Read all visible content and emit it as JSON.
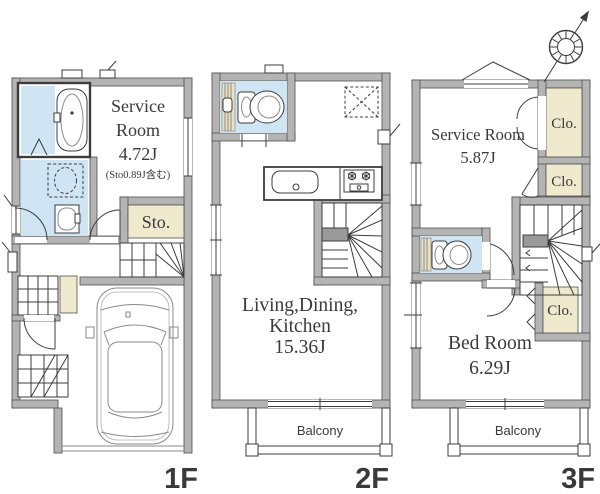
{
  "floor_plan": {
    "floors": [
      {
        "id": "1F",
        "label": "1F",
        "rooms": {
          "service_room": {
            "line1": "Service",
            "line2": "Room",
            "size": "4.72J",
            "note": "(Sto0.89J含む)"
          },
          "storage": "Sto."
        }
      },
      {
        "id": "2F",
        "label": "2F",
        "rooms": {
          "ldk": {
            "line1": "Living,Dining,",
            "line2": "Kitchen",
            "size": "15.36J"
          },
          "balcony": "Balcony"
        }
      },
      {
        "id": "3F",
        "label": "3F",
        "rooms": {
          "service_room": {
            "name": "Service Room",
            "size": "5.87J"
          },
          "closet_top": "Clo.",
          "closet_mid": "Clo.",
          "closet_lower": "Clo.",
          "bedroom": {
            "name": "Bed Room",
            "size": "6.29J"
          },
          "balcony": "Balcony"
        }
      }
    ],
    "colors": {
      "wall_gray": "#b4b4b4",
      "water_blue": "#cfe5f4",
      "closet_cream": "#efe9cd",
      "floor_label_green": "#19573b",
      "line_dark": "#3c3c3c"
    }
  }
}
